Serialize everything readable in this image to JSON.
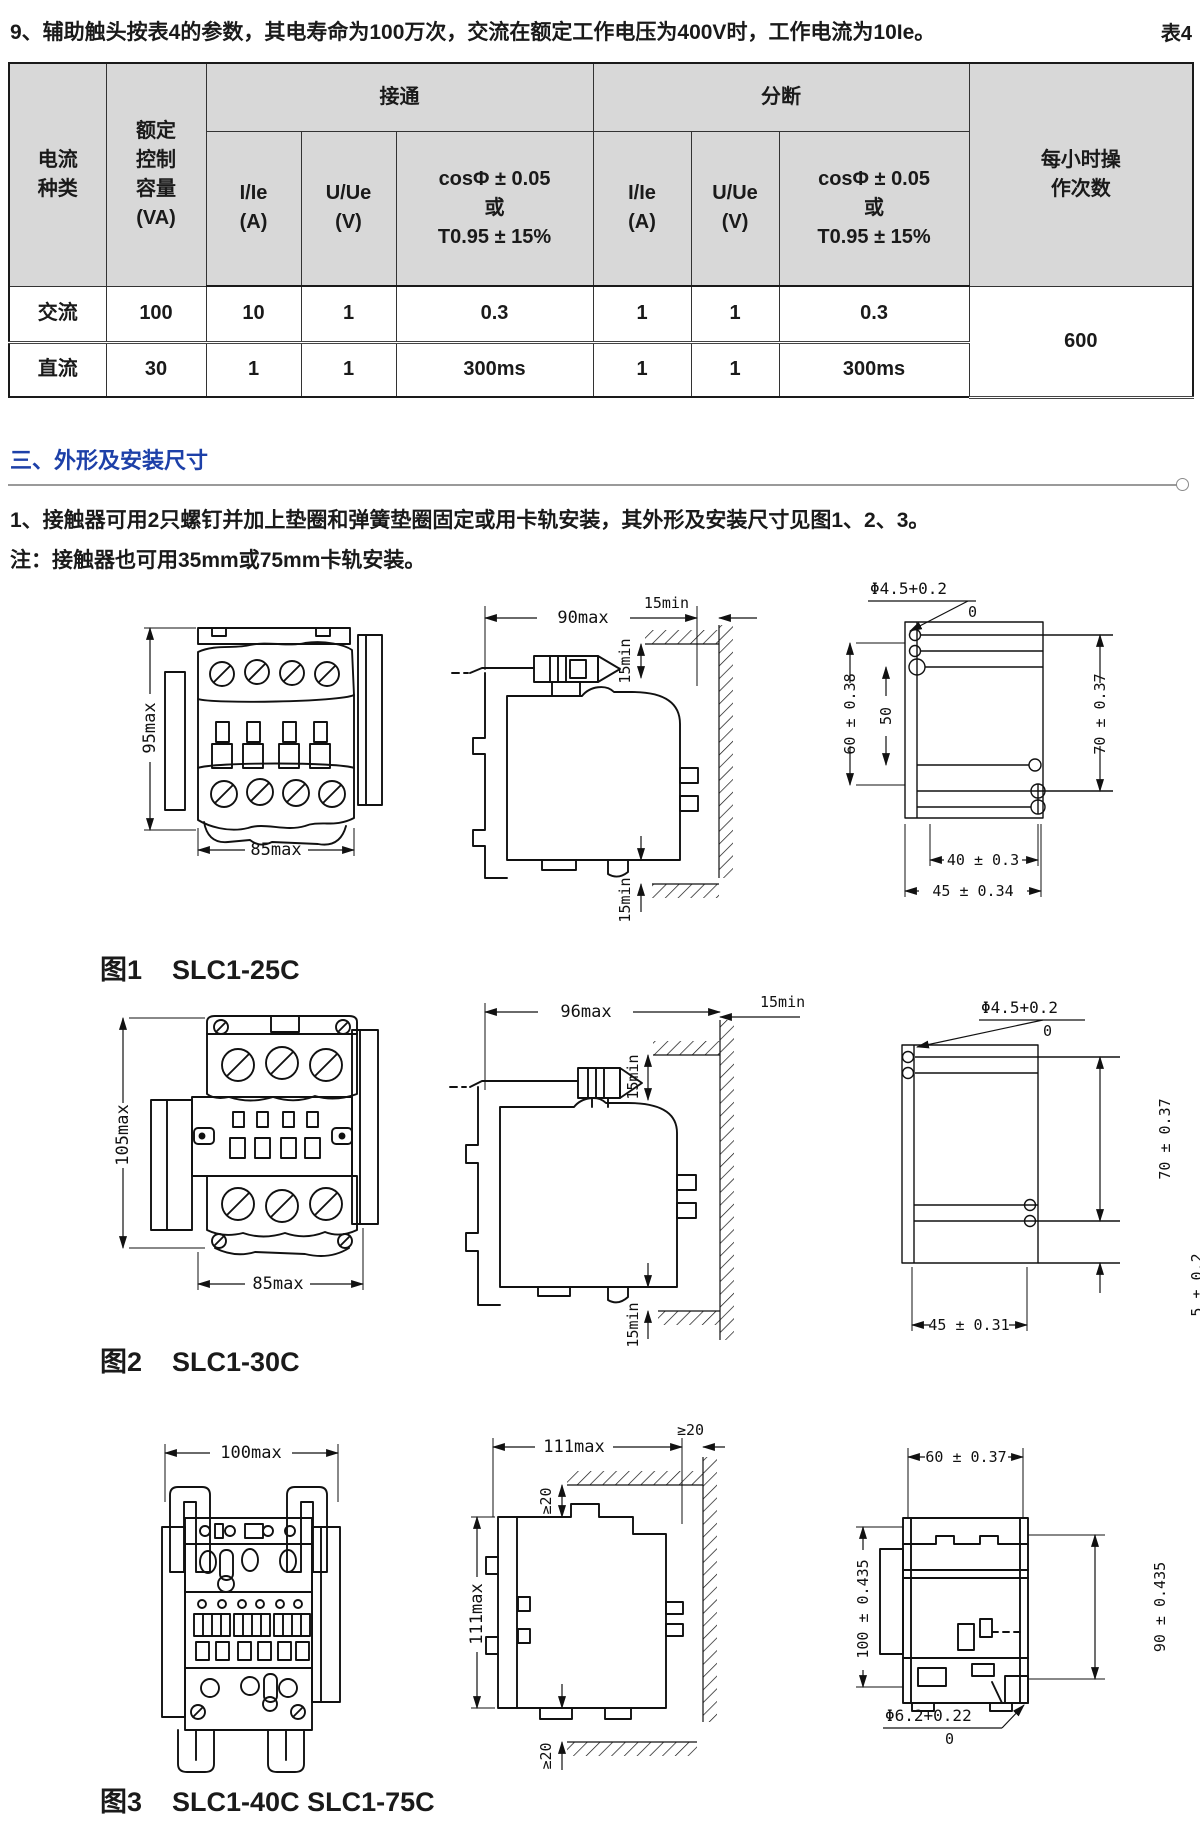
{
  "page": {
    "heading": "9、辅助触头按表4的参数，其电寿命为100万次，交流在额定工作电压为400V时，工作电流为10Ie。",
    "table_tag": "表4"
  },
  "table": {
    "h_current_type": "电流\n种类",
    "h_capacity": "额定\n控制\n容量\n(VA)",
    "h_close": "接通",
    "h_break": "分断",
    "h_i": "I/Ie\n(A)",
    "h_u": "U/Ue\n(V)",
    "h_cos": "cosΦ ± 0.05\n或\nT0.95 ± 15%",
    "h_ops": "每小时操\n作次数",
    "rows": [
      {
        "type": "交流",
        "cap": "100",
        "ci": "10",
        "cu": "1",
        "ccos": "0.3",
        "bi": "1",
        "bu": "1",
        "bcos": "0.3"
      },
      {
        "type": "直流",
        "cap": "30",
        "ci": "1",
        "cu": "1",
        "ccos": "300ms",
        "bi": "1",
        "bu": "1",
        "bcos": "300ms"
      }
    ],
    "ops": "600"
  },
  "section": {
    "title": "三、外形及安装尺寸",
    "para1": "1、接触器可用2只螺钉并加上垫圈和弹簧垫圈固定或用卡轨安装，其外形及安装尺寸见图1、2、3。",
    "para2": "注：接触器也可用35mm或75mm卡轨安装。"
  },
  "fig1": {
    "no": "图1",
    "model": "SLC1-25C",
    "front_h": "95max",
    "front_w": "85max",
    "side_w": "90max",
    "gap_top": "15min",
    "gap_mid": "15min",
    "gap_bottom": "15min",
    "hole": "Φ4.5+0.2",
    "hole_tol": "0",
    "m_v1": "60 ± 0.38",
    "m_v2": "50",
    "m_v3": "70 ± 0.37",
    "m_h1": "40 ± 0.3",
    "m_h2": "45 ± 0.34"
  },
  "fig2": {
    "no": "图2",
    "model": "SLC1-30C",
    "front_h": "105max",
    "front_w": "85max",
    "side_w": "96max",
    "gap_top": "15min",
    "gap_mid": "15min",
    "gap_bottom": "15min",
    "hole": "Φ4.5+0.2",
    "hole_tol": "0",
    "m_v1": "70 ± 0.37",
    "m_v2": "5 ± 0.2",
    "m_h1": "45 ± 0.31"
  },
  "fig3": {
    "no": "图3",
    "model": "SLC1-40C SLC1-75C",
    "front_w": "100max",
    "side_w": "111max",
    "side_h": "111max",
    "gap_top": "≥20",
    "gap_side": "≥20",
    "gap_bottom": "≥20",
    "m_top": "60 ± 0.37",
    "m_left": "100 ± 0.435",
    "m_right": "90 ± 0.435",
    "hole": "Φ6.2+0.22",
    "hole_tol": "0"
  }
}
